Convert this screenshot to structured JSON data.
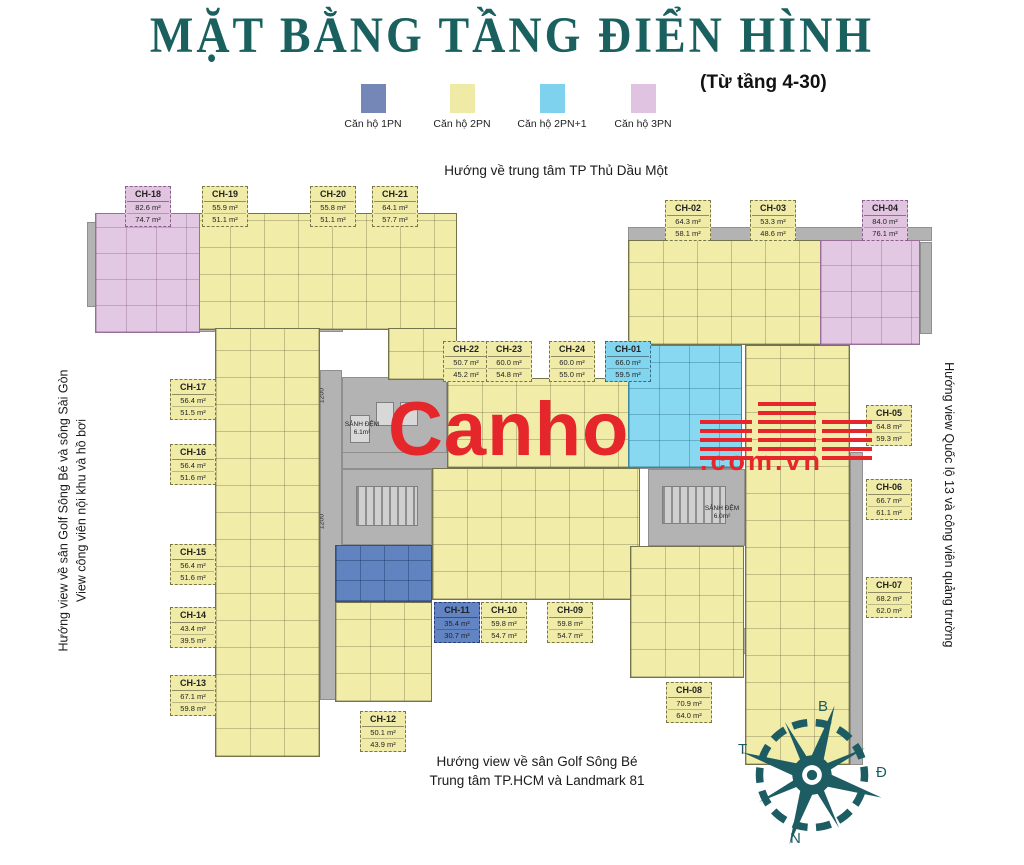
{
  "title": "MẶT BẰNG TẦNG ĐIỂN HÌNH",
  "subtitle": "(Từ tầng 4-30)",
  "legend": {
    "items": [
      {
        "label": "Căn hộ 1PN",
        "color": "#7487b7"
      },
      {
        "label": "Căn hộ 2PN",
        "color": "#efeba6"
      },
      {
        "label": "Căn hộ 2PN+1",
        "color": "#7fd2ee"
      },
      {
        "label": "Căn hộ 3PN",
        "color": "#dfc3e0"
      }
    ]
  },
  "directions": {
    "top": "Hướng về trung tâm TP Thủ Dầu Một",
    "left1": "Hướng view về sân Golf Sông Bé và sông Sài Gòn",
    "left2": "View công viên nội khu và hồ bơi",
    "right": "Hướng view Quốc lộ 13 và công viên quảng trường",
    "bottom1": "Hướng view về sân Golf Sông Bé",
    "bottom2": "Trung tâm TP.HCM và Landmark 81"
  },
  "watermark": {
    "brand": "Canho",
    "suffix": ".com.vn",
    "color": "#e5262b"
  },
  "compass": {
    "north": "B",
    "east": "Đ",
    "south": "N",
    "west": "T",
    "color": "#1d5c63"
  },
  "plan": {
    "lobby1": {
      "name": "SẢNH ĐỆM",
      "area": "6.1m²"
    },
    "lobby2": {
      "name": "SẢNH ĐỆM",
      "area": "6.0m²"
    },
    "dims": [
      "1200",
      "1200",
      "1200"
    ]
  },
  "units": [
    {
      "id": "CH-01",
      "type": "2PN+1",
      "gross": "66.0 m²",
      "net": "59.5 m²"
    },
    {
      "id": "CH-02",
      "type": "2PN",
      "gross": "64.3 m²",
      "net": "58.1 m²"
    },
    {
      "id": "CH-03",
      "type": "2PN",
      "gross": "53.3 m²",
      "net": "48.6 m²"
    },
    {
      "id": "CH-04",
      "type": "3PN",
      "gross": "84.0 m²",
      "net": "76.1 m²"
    },
    {
      "id": "CH-05",
      "type": "2PN",
      "gross": "64.8 m²",
      "net": "59.3 m²"
    },
    {
      "id": "CH-06",
      "type": "2PN",
      "gross": "66.7 m²",
      "net": "61.1 m²"
    },
    {
      "id": "CH-07",
      "type": "2PN",
      "gross": "68.2 m²",
      "net": "62.0 m²"
    },
    {
      "id": "CH-08",
      "type": "2PN",
      "gross": "70.9 m²",
      "net": "64.0 m²"
    },
    {
      "id": "CH-09",
      "type": "2PN",
      "gross": "59.8 m²",
      "net": "54.7 m²"
    },
    {
      "id": "CH-10",
      "type": "2PN",
      "gross": "59.8 m²",
      "net": "54.7 m²"
    },
    {
      "id": "CH-11",
      "type": "1PN",
      "gross": "35.4 m²",
      "net": "30.7 m²"
    },
    {
      "id": "CH-12",
      "type": "2PN",
      "gross": "50.1 m²",
      "net": "43.9 m²"
    },
    {
      "id": "CH-13",
      "type": "2PN",
      "gross": "67.1 m²",
      "net": "59.8 m²"
    },
    {
      "id": "CH-14",
      "type": "2PN",
      "gross": "43.4 m²",
      "net": "39.5 m²"
    },
    {
      "id": "CH-15",
      "type": "2PN",
      "gross": "56.4 m²",
      "net": "51.6 m²"
    },
    {
      "id": "CH-16",
      "type": "2PN",
      "gross": "56.4 m²",
      "net": "51.6 m²"
    },
    {
      "id": "CH-17",
      "type": "2PN",
      "gross": "56.4 m²",
      "net": "51.5 m²"
    },
    {
      "id": "CH-18",
      "type": "3PN",
      "gross": "82.6 m²",
      "net": "74.7 m²"
    },
    {
      "id": "CH-19",
      "type": "2PN",
      "gross": "55.9 m²",
      "net": "51.1 m²"
    },
    {
      "id": "CH-20",
      "type": "2PN",
      "gross": "55.8 m²",
      "net": "51.1 m²"
    },
    {
      "id": "CH-21",
      "type": "2PN",
      "gross": "64.1 m²",
      "net": "57.7 m²"
    },
    {
      "id": "CH-22",
      "type": "2PN",
      "gross": "50.7 m²",
      "net": "45.2 m²"
    },
    {
      "id": "CH-23",
      "type": "2PN",
      "gross": "60.0 m²",
      "net": "54.8 m²"
    },
    {
      "id": "CH-24",
      "type": "2PN",
      "gross": "60.0 m²",
      "net": "55.0 m²"
    }
  ]
}
